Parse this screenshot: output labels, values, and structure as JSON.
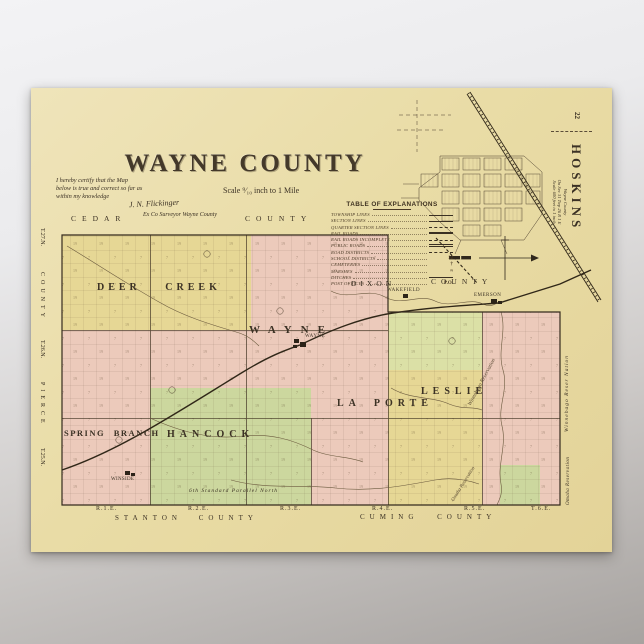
{
  "background": {
    "gradient_top": "#f3f3f5",
    "gradient_bottom": "#a7a3a0"
  },
  "poster": {
    "paper_color": "#e9dca6",
    "ink_color": "#3b3124",
    "page_number": "22",
    "title": "WAYNE COUNTY",
    "scale_note": "Scale ⁹⁄₁₀ inch to 1 Mile",
    "certification": {
      "line1": "I hereby certify that the Map",
      "line2": "below is true and correct so far as",
      "line3": "within my knowledge",
      "signature": "J. N. Flickinger",
      "signer_title": "Ex Co Surveyor Wayne County"
    },
    "legend": {
      "title": "TABLE OF EXPLANATIONS",
      "items": [
        {
          "label": "TOWNSHIP LINES",
          "symbol": "line-heavy"
        },
        {
          "label": "SECTION LINES",
          "symbol": "line-thin"
        },
        {
          "label": "QUARTER SECTION LINES",
          "symbol": "line-dashed-thin"
        },
        {
          "label": "RAIL ROADS",
          "symbol": "line-railroad"
        },
        {
          "label": "RAIL ROADS INCOMPLETE",
          "symbol": "line-dashed-heavy"
        },
        {
          "label": "PUBLIC ROADS",
          "symbol": "line-double"
        },
        {
          "label": "ROAD DISTRICTS",
          "symbol": "line-dashed"
        },
        {
          "label": "SCHOOL DISTRICTS",
          "symbol": "numeral",
          "symbol_text": "12"
        },
        {
          "label": "CEMETERIES",
          "symbol": "cross-glyph",
          "symbol_text": "†"
        },
        {
          "label": "MARSHES",
          "symbol": "marsh-glyph",
          "symbol_text": "≈"
        },
        {
          "label": "DITCHES",
          "symbol": "line-thin"
        },
        {
          "label": "POST OFFICES",
          "symbol": "text",
          "symbol_text": "P.O."
        }
      ]
    },
    "inset": {
      "title": "HOSKINS",
      "caption_line1": "Wayne County",
      "caption_line2": "On Sec 31 Twp 26 R 1 E",
      "caption_line3": "Scale 600 feet to 1 inch"
    },
    "map_colors": {
      "paper": "#ecdfae",
      "yellow": "#e6d795",
      "pink": "#eccabb",
      "green": "#ccd79e",
      "green_light": "#dbe0a6"
    },
    "map": {
      "neighbors": {
        "top_left": "CEDAR",
        "top_right": "COUNTY",
        "dixon": "DIXON",
        "dixon_county": "COUNTY",
        "bottom_left": "STANTON COUNTY",
        "bottom_right": "CUMING COUNTY"
      },
      "left_edge": [
        "T.27.N.",
        "COUNTY",
        "T.26.N.",
        "PIERCE",
        "T.25.N."
      ],
      "ranges": [
        "R.1.E.",
        "R.2.E.",
        "R.3.E.",
        "R.4.E.",
        "R.5.E.",
        "T.6.E."
      ],
      "townships": [
        "DEER CREEK",
        "WAYNE",
        "LA PORTE",
        "LESLIE",
        "SPRING BRANCH",
        "HANCOCK"
      ],
      "towns": {
        "wayne": "WAYNE",
        "wakefield": "WAKEFIELD",
        "emerson": "EMERSON",
        "winside": "WINSIDE"
      },
      "annotations": {
        "reservation_edge_1": "Winnebago Reser Nation",
        "reservation_edge_2": "Omaha Reservation",
        "reservation_in_1": "Winnebago Reservation",
        "reservation_in_2": "Omaha Reservation",
        "parallel": "6th Standard Parallel North"
      }
    }
  }
}
